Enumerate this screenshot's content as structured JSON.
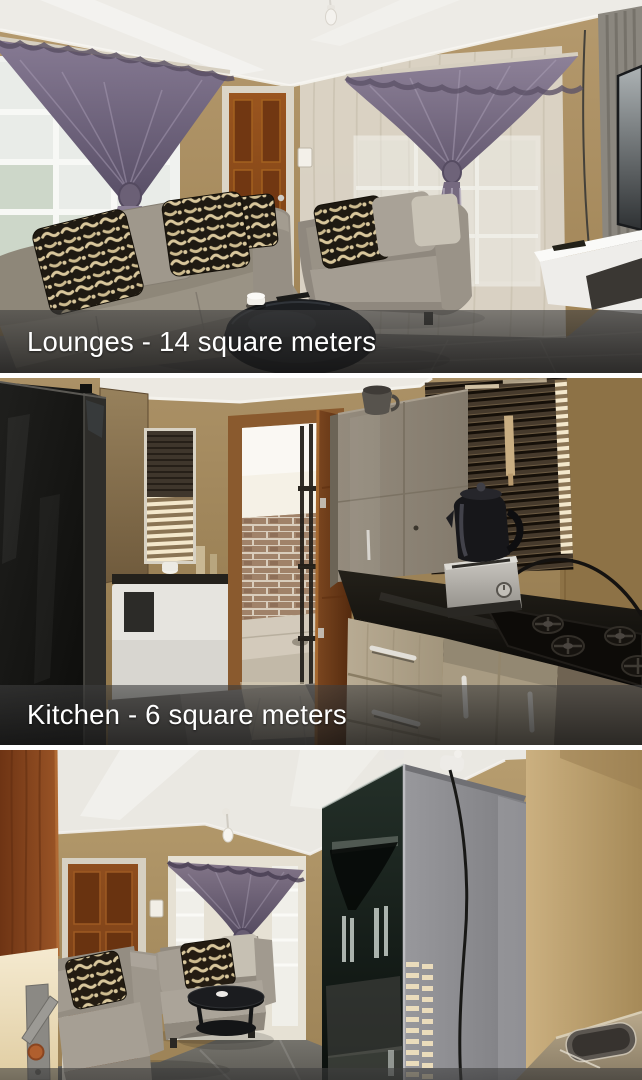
{
  "gallery": {
    "divider_color": "#ffffff",
    "caption_bar_color": "rgba(35,35,35,0.72)",
    "caption_text_color": "#ffffff",
    "photos": [
      {
        "caption": "Lounges - 14 square meters",
        "alt": "Lounge with two grey couches, black and cream patterned scatter cushions, round black coffee table with a white cup, two windows with dark drape curtains tied at the middle over net curtains, a wooden front door and a wall-mounted TV above a white floating cabinet"
      },
      {
        "caption": "Kitchen - 6 square meters",
        "alt": "Kitchen with a black fridge, small window with venetian blinds, open wooden door to a brick-walled sunny yard through a security gate, grey cupboard with a jug on top, large window with dark venetian blinds, black kettle on a silver toaster oven, gas hob set in a black countertop above light cupboard doors and drawers"
      },
      {
        "caption": "",
        "alt": "Second view of the lounge seen past an open wooden door: brown interior door, window with tied drape curtain, two grey couches with patterned cushions, round black coffee table, tall mirrored cabinet reflecting the window, sunlit wall and a stainless sink corner"
      }
    ]
  }
}
